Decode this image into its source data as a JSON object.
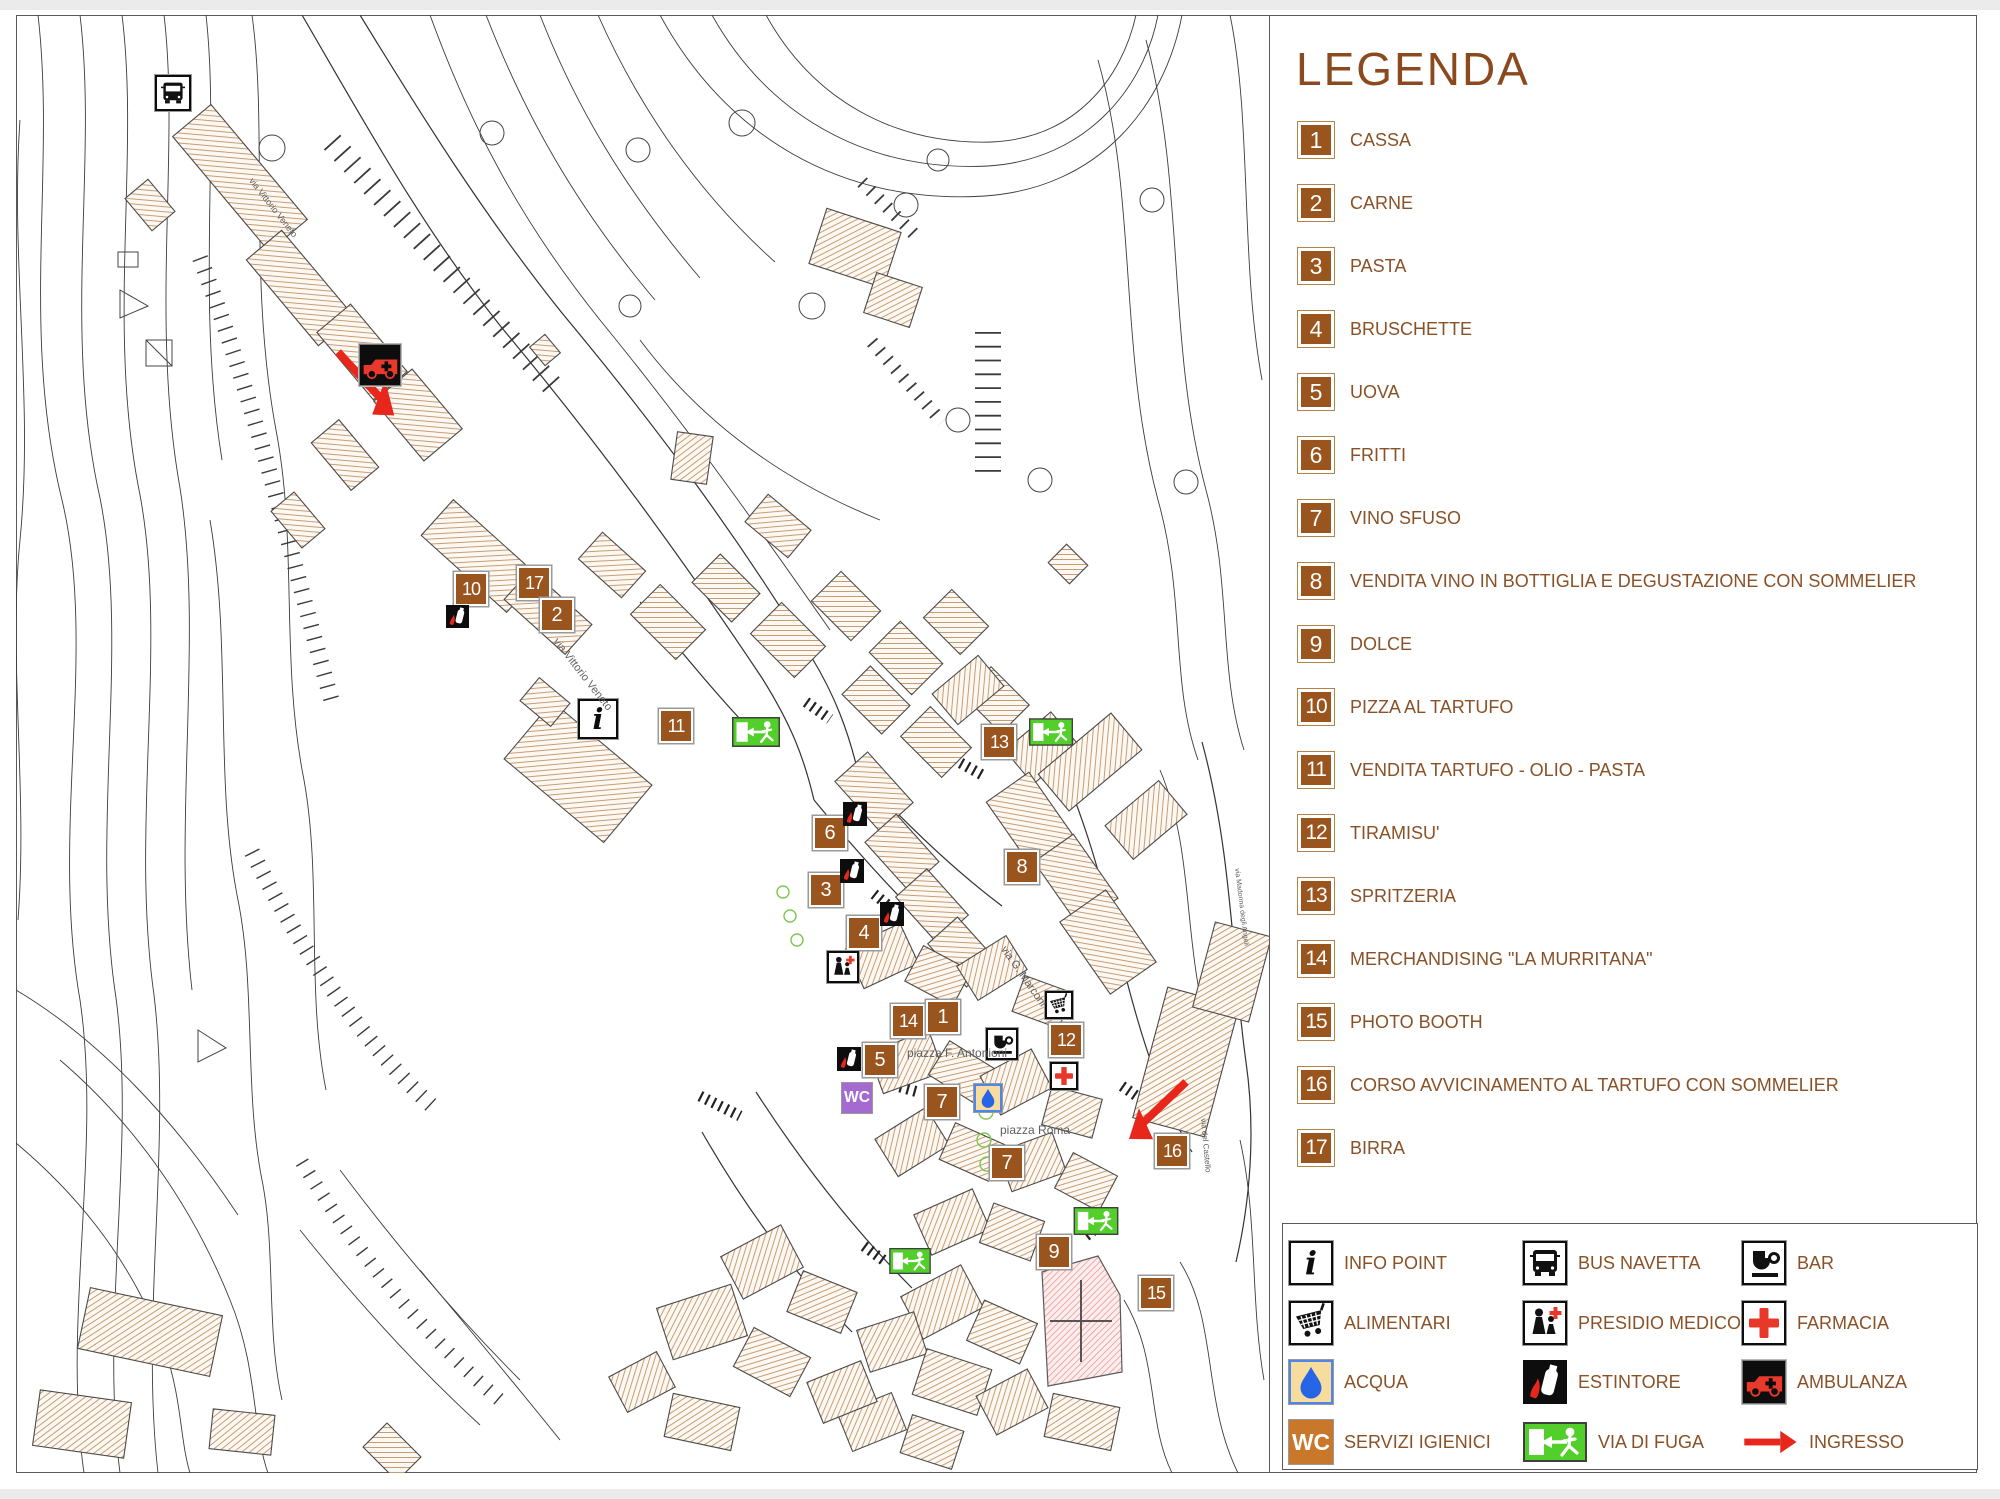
{
  "legend": {
    "title": "LEGENDA",
    "items": [
      {
        "num": "1",
        "label": "CASSA"
      },
      {
        "num": "2",
        "label": "CARNE"
      },
      {
        "num": "3",
        "label": "PASTA"
      },
      {
        "num": "4",
        "label": "BRUSCHETTE"
      },
      {
        "num": "5",
        "label": "UOVA"
      },
      {
        "num": "6",
        "label": "FRITTI"
      },
      {
        "num": "7",
        "label": "VINO SFUSO"
      },
      {
        "num": "8",
        "label": "VENDITA VINO IN BOTTIGLIA E DEGUSTAZIONE CON SOMMELIER"
      },
      {
        "num": "9",
        "label": "DOLCE"
      },
      {
        "num": "10",
        "label": "PIZZA AL TARTUFO"
      },
      {
        "num": "11",
        "label": "VENDITA TARTUFO - OLIO - PASTA"
      },
      {
        "num": "12",
        "label": "TIRAMISU'"
      },
      {
        "num": "13",
        "label": "SPRITZERIA"
      },
      {
        "num": "14",
        "label": "MERCHANDISING \"LA MURRITANA\""
      },
      {
        "num": "15",
        "label": "PHOTO BOOTH"
      },
      {
        "num": "16",
        "label": "CORSO AVVICINAMENTO AL TARTUFO CON SOMMELIER"
      },
      {
        "num": "17",
        "label": "BIRRA"
      }
    ]
  },
  "icon_legend": {
    "items": [
      {
        "icon": "info",
        "label": "INFO POINT"
      },
      {
        "icon": "cart",
        "label": "ALIMENTARI"
      },
      {
        "icon": "acqua",
        "label": "ACQUA"
      },
      {
        "icon": "wc",
        "label": "SERVIZI IGIENICI",
        "color": "#c8772b"
      },
      {
        "icon": "bus",
        "label": "BUS NAVETTA"
      },
      {
        "icon": "medico",
        "label": "PRESIDIO MEDICO"
      },
      {
        "icon": "estintore",
        "label": "ESTINTORE"
      },
      {
        "icon": "exit",
        "label": "VIA DI FUGA"
      },
      {
        "icon": "bar",
        "label": "BAR"
      },
      {
        "icon": "farmacia",
        "label": "FARMACIA"
      },
      {
        "icon": "ambulanza",
        "label": "AMBULANZA"
      },
      {
        "icon": "ingresso",
        "label": "INGRESSO"
      }
    ]
  },
  "map": {
    "markers": [
      {
        "num": "10",
        "x": 469,
        "y": 587
      },
      {
        "num": "17",
        "x": 532,
        "y": 581
      },
      {
        "num": "2",
        "x": 555,
        "y": 613
      },
      {
        "num": "11",
        "x": 674,
        "y": 724
      },
      {
        "num": "13",
        "x": 997,
        "y": 740
      },
      {
        "num": "6",
        "x": 828,
        "y": 831
      },
      {
        "num": "3",
        "x": 824,
        "y": 888
      },
      {
        "num": "4",
        "x": 862,
        "y": 931
      },
      {
        "num": "8",
        "x": 1020,
        "y": 865
      },
      {
        "num": "14",
        "x": 906,
        "y": 1019
      },
      {
        "num": "1",
        "x": 941,
        "y": 1015
      },
      {
        "num": "5",
        "x": 878,
        "y": 1058
      },
      {
        "num": "12",
        "x": 1064,
        "y": 1038
      },
      {
        "num": "7",
        "x": 940,
        "y": 1100
      },
      {
        "num": "16",
        "x": 1170,
        "y": 1149
      },
      {
        "num": "7",
        "x": 1005,
        "y": 1161
      },
      {
        "num": "9",
        "x": 1052,
        "y": 1250
      },
      {
        "num": "15",
        "x": 1154,
        "y": 1291
      }
    ],
    "icons": [
      {
        "type": "bus",
        "x": 173,
        "y": 93,
        "w": 36,
        "h": 36
      },
      {
        "type": "ambulanza",
        "x": 380,
        "y": 365,
        "w": 42,
        "h": 42
      },
      {
        "type": "info",
        "x": 598,
        "y": 719,
        "w": 40,
        "h": 40
      },
      {
        "type": "medico",
        "x": 843,
        "y": 967,
        "w": 32,
        "h": 32
      },
      {
        "type": "bar",
        "x": 1002,
        "y": 1044,
        "w": 32,
        "h": 32
      },
      {
        "type": "cart",
        "x": 1059,
        "y": 1005,
        "w": 28,
        "h": 28
      },
      {
        "type": "farmacia",
        "x": 1064,
        "y": 1076,
        "w": 28,
        "h": 28
      },
      {
        "type": "acqua",
        "x": 988,
        "y": 1098,
        "w": 28,
        "h": 28
      },
      {
        "type": "wc",
        "x": 857,
        "y": 1098,
        "w": 30,
        "h": 30,
        "color": "#a46ad0"
      },
      {
        "type": "estintore",
        "x": 457,
        "y": 616,
        "w": 23,
        "h": 23
      },
      {
        "type": "estintore",
        "x": 855,
        "y": 814,
        "w": 24,
        "h": 24
      },
      {
        "type": "estintore",
        "x": 852,
        "y": 871,
        "w": 24,
        "h": 24
      },
      {
        "type": "estintore",
        "x": 892,
        "y": 914,
        "w": 24,
        "h": 24
      },
      {
        "type": "estintore",
        "x": 849,
        "y": 1059,
        "w": 24,
        "h": 24
      },
      {
        "type": "exit",
        "x": 756,
        "y": 732,
        "w": 48,
        "h": 30
      },
      {
        "type": "exit",
        "x": 1051,
        "y": 732,
        "w": 44,
        "h": 28
      },
      {
        "type": "exit",
        "x": 1096,
        "y": 1221,
        "w": 46,
        "h": 28
      },
      {
        "type": "exit",
        "x": 910,
        "y": 1261,
        "w": 44,
        "h": 26
      }
    ],
    "street_labels": [
      {
        "text": "via Vittorio Veneto",
        "x": 255,
        "y": 176,
        "rot": 52,
        "size": 9
      },
      {
        "text": "via Vittorio Veneto",
        "x": 560,
        "y": 636,
        "rot": 52,
        "size": 11
      },
      {
        "text": "via G. Marconi",
        "x": 1008,
        "y": 944,
        "rot": 55,
        "size": 11
      },
      {
        "text": "via Madonna degli Angeli",
        "x": 1240,
        "y": 868,
        "rot": 83,
        "size": 7
      },
      {
        "text": "via del Castello",
        "x": 1208,
        "y": 1118,
        "rot": 85,
        "size": 8
      },
      {
        "text": "piazza F. Antonioni",
        "x": 907,
        "y": 1046,
        "rot": 0,
        "size": 12
      },
      {
        "text": "piazza Roma",
        "x": 1000,
        "y": 1123,
        "rot": 0,
        "size": 12
      }
    ]
  }
}
